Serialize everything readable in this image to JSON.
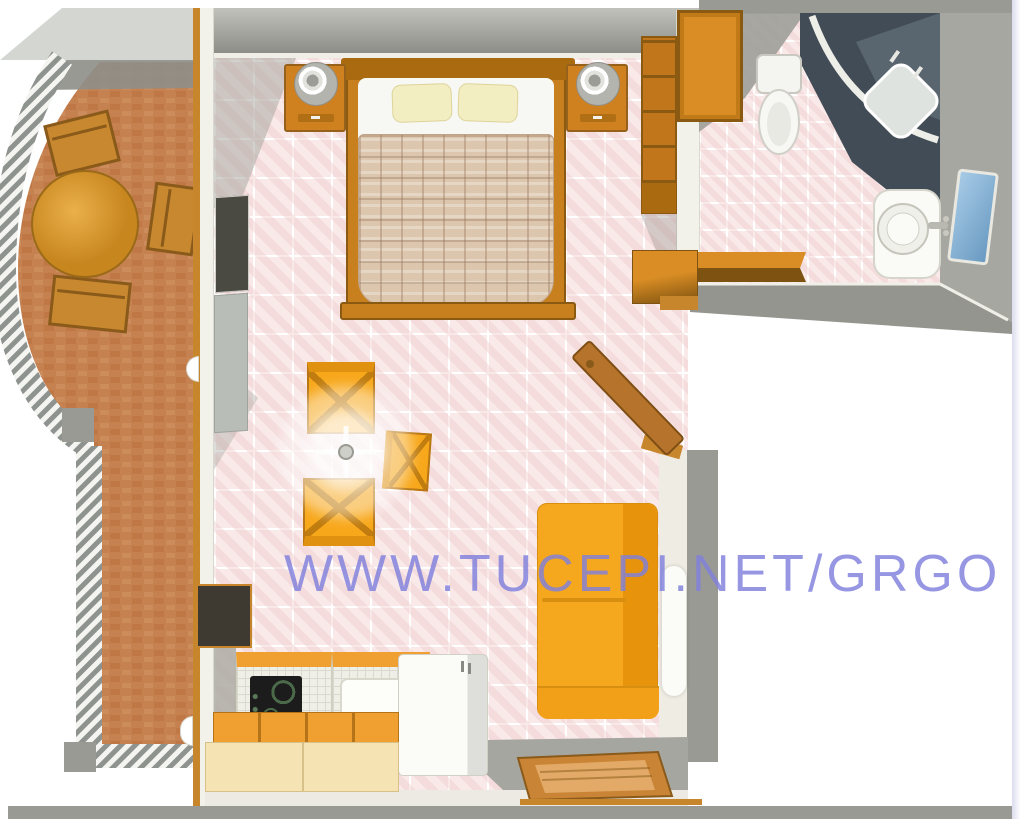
{
  "watermark": {
    "text": "WWW.TUCEPI.NET/GRGO",
    "color": "#8080dd"
  },
  "palette": {
    "wall_gray": "#9a9a94",
    "wall_mid": "#c2c2bc",
    "wall_dark": "#8d8d87",
    "wall_light": "#f2f2ea",
    "floor_pink": "#f9e9e9",
    "brick": "#c5814f",
    "brick_dark": "#b9713c",
    "railing": "#8f938f",
    "wood": "#c8862c",
    "wood_dark": "#8a5a12",
    "bedframe": "#c8801f",
    "furn_orange": "#d98d24",
    "chair_orange": "#f7a71a",
    "sofa_orange": "#f5a71d",
    "k_orange": "#f0a030",
    "cream": "#f5e3b3",
    "pillow": "#f3edc2",
    "blanket": "#dcc6ae",
    "cooktop": "#1c1c1c",
    "shower_dark": "#414c56",
    "mirror_blue": "#79a8d0"
  },
  "scene": {
    "type": "apartment-floor-plan-3d",
    "rooms": [
      {
        "id": "balcony",
        "items": [
          "round-table",
          "chair",
          "chair",
          "chair",
          "curved-railing",
          "brick-floor"
        ]
      },
      {
        "id": "main-room",
        "items": [
          "double-bed",
          "nightstand-left",
          "nightstand-right",
          "wardrobe",
          "wall-shelf",
          "dining-chairs",
          "ceiling-lamp",
          "sofa",
          "kitchen-counter",
          "cooktop",
          "kitchen-sink",
          "fridge",
          "lower-cabinets",
          "doormat",
          "entry-door"
        ]
      },
      {
        "id": "bathroom",
        "items": [
          "corner-shower",
          "toilet",
          "wash-basin",
          "mirror",
          "shelf"
        ]
      }
    ]
  }
}
